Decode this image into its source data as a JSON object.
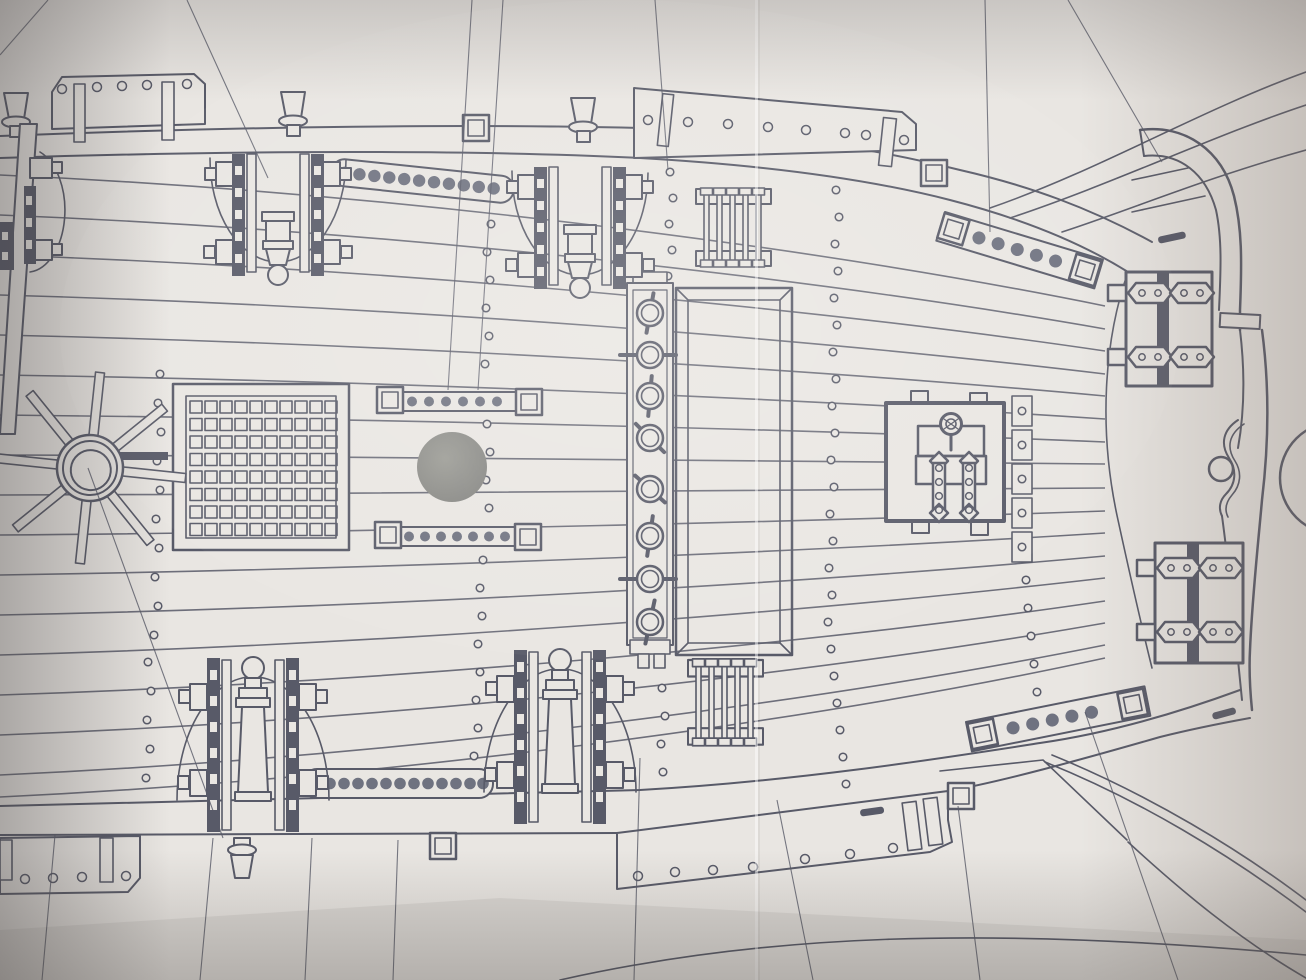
{
  "meta": {
    "description": "Photograph of a paper sheet bearing a model-ship deck plan (plan view), ink line drawing, no printed text visible",
    "drawing_type": "ship deck plan",
    "sheet": "off-white drawing paper with corner shading and fold creases"
  },
  "palette": {
    "paper": "#e9e6e2",
    "ink": "#585a68",
    "dotfill": "#6f7280",
    "mastfill": "#8f8f8a",
    "edge_shade": "#8a8582",
    "crease": "#f7f5f2"
  },
  "components": {
    "ships_wheel": {
      "label": "ship's wheel with 8 spokes and double-ring hub"
    },
    "hatch_grating": {
      "label": "main hatch grating",
      "cols": 10,
      "rows": 8
    },
    "mast_hole": {
      "label": "filled mast hole"
    },
    "ring_rail": {
      "label": "ring-bolt rail with 8 toggled rings",
      "rings": 8
    },
    "coaming": {
      "label": "hatch coaming frame with mitered corners"
    },
    "ladder_top": {
      "label": "companion ladder (top)",
      "rungs": 5
    },
    "ladder_bottom": {
      "label": "companion ladder (bottom)",
      "rungs": 5
    },
    "cannons": {
      "label": "cannons on carriages with recoil arcs",
      "count": 4
    },
    "pin_rails": {
      "label": "pin rails with belaying-pin holes",
      "count": 6
    },
    "deck_planks": {
      "label": "deck planking lines",
      "lines": 17
    },
    "treenails": {
      "label": "dotted treenail rows",
      "rows": 6
    },
    "deck_box": {
      "label": "deck locker with ring handle and two hinge straps"
    },
    "channel_plates": {
      "label": "chain-plate channels with strap fittings",
      "count": 2
    },
    "bulwarks": {
      "label": "bulwark rails with timberheads and drilled cap planks",
      "timberheads": 4
    },
    "hull_bow": {
      "label": "bow stem band with scroll molding and hawse circle"
    },
    "rigging_lines": {
      "label": "straight rigging reference lines",
      "count": 16
    }
  }
}
